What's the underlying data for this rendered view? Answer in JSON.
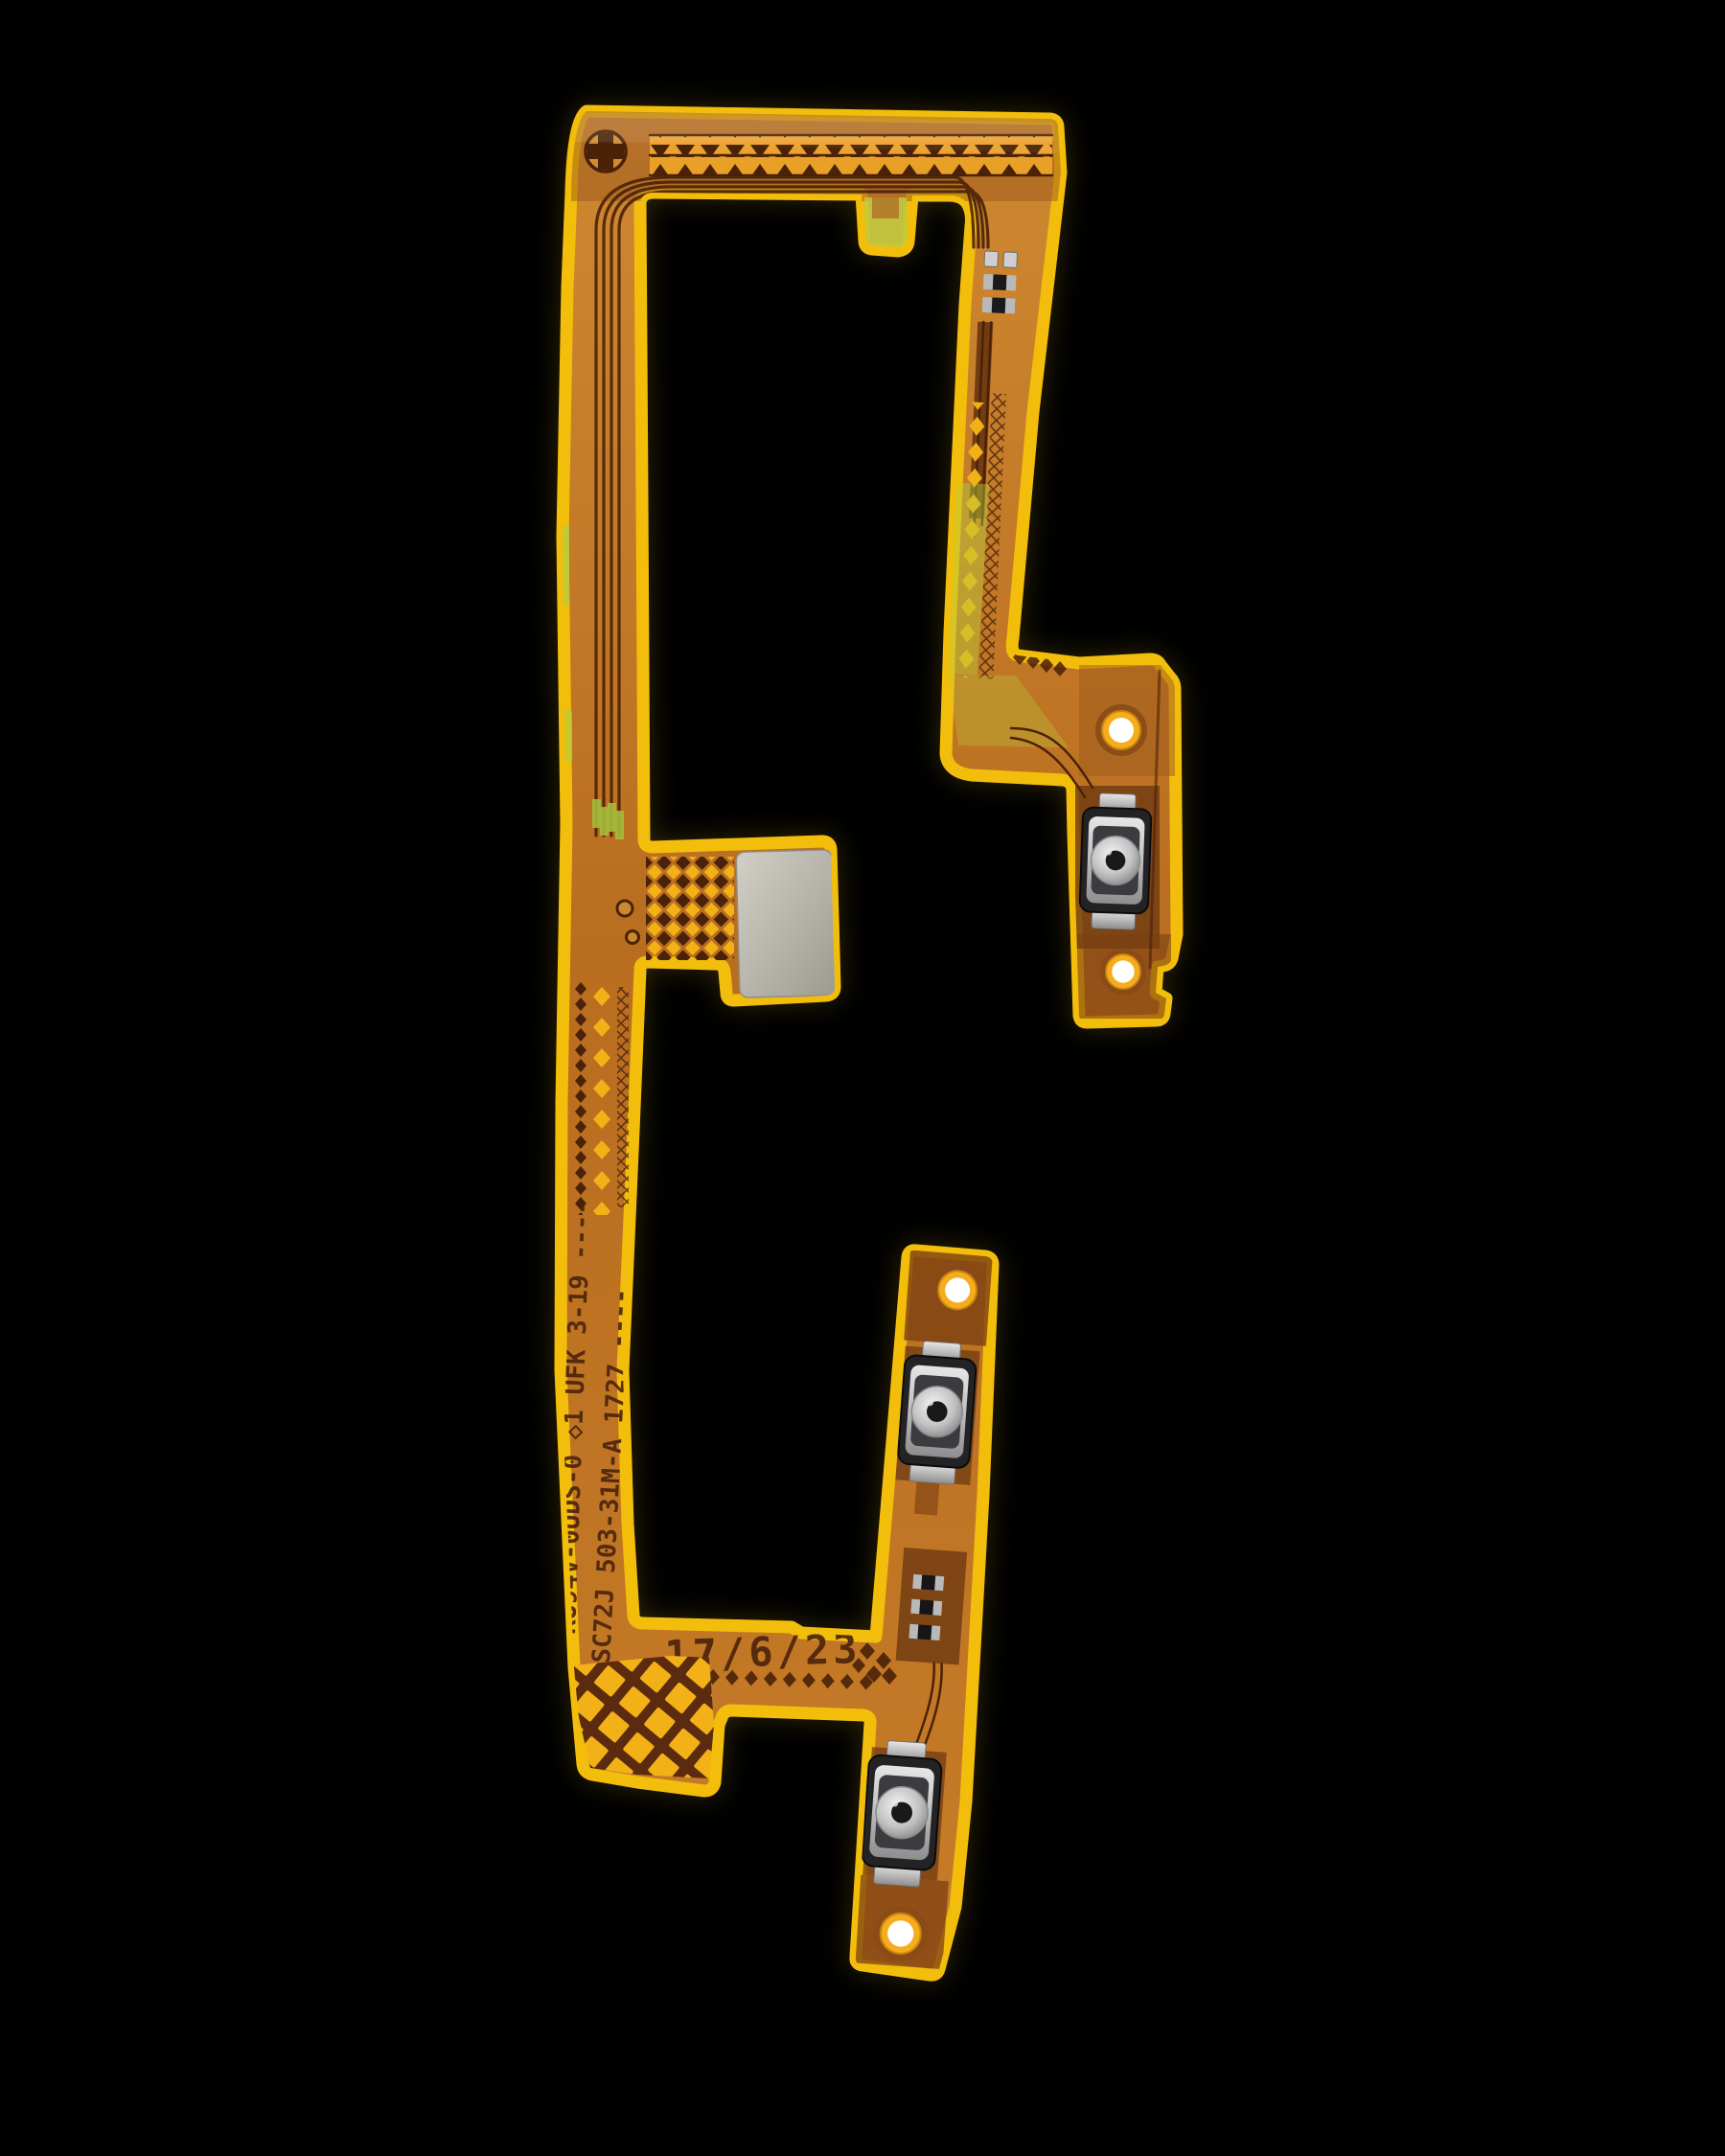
{
  "photo": {
    "background_color": "#000000",
    "subject": "power-volume-button-flex-cable"
  },
  "markings": {
    "ul_line": "RU94V-0UDS-0 ◇1 UFK 3-19 ----",
    "lot_line": "SC72J 503-31M-A 1727 ----",
    "date_code": "17/6/23"
  },
  "palette": {
    "background": "#000000",
    "coverlay_edge_yellow": "#f3be0b",
    "body_orange": "#c07a28",
    "body_brown_dark": "#6e3a12",
    "copper_trace": "#4a2208",
    "via_pad_yellow": "#f2b117",
    "green_tint": "#b5cc3e",
    "stiffener_gray": "#b7b5ac",
    "switch_frame_dark": "#232326",
    "switch_metal_silver": "#c9c9c9",
    "screw_hole_white": "#ffffff",
    "stamp_ink": "#4c240c"
  }
}
